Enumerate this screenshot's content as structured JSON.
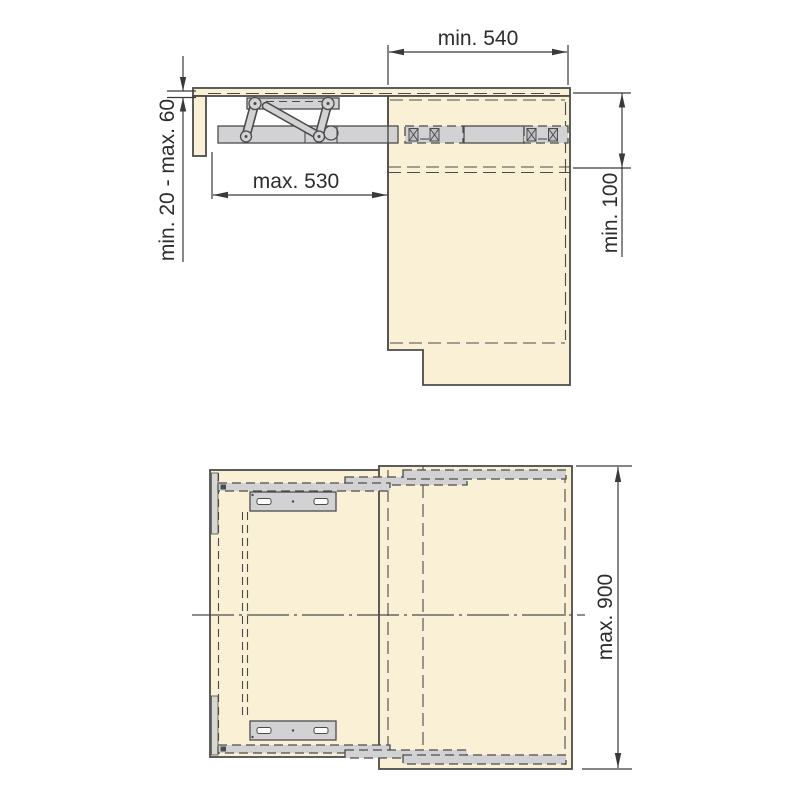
{
  "palette": {
    "background": "#ffffff",
    "panel-fill": "#faf0d6",
    "metal-fill": "#d2d2d4",
    "metal-light": "#d8d8d2",
    "line": "#4b4b4b",
    "text": "#2d2d2d"
  },
  "side_view": {
    "name": "side view of fold-out table mechanism",
    "dimensions": {
      "cabinet_width": "min. 540",
      "top_clearance": "min. 20 - max. 60",
      "extension": "max. 530",
      "mechanism_clearance": "min. 100"
    }
  },
  "plan_view": {
    "name": "plan view of table panel with slide rails",
    "dimensions": {
      "cabinet_length": "max. 900"
    }
  }
}
